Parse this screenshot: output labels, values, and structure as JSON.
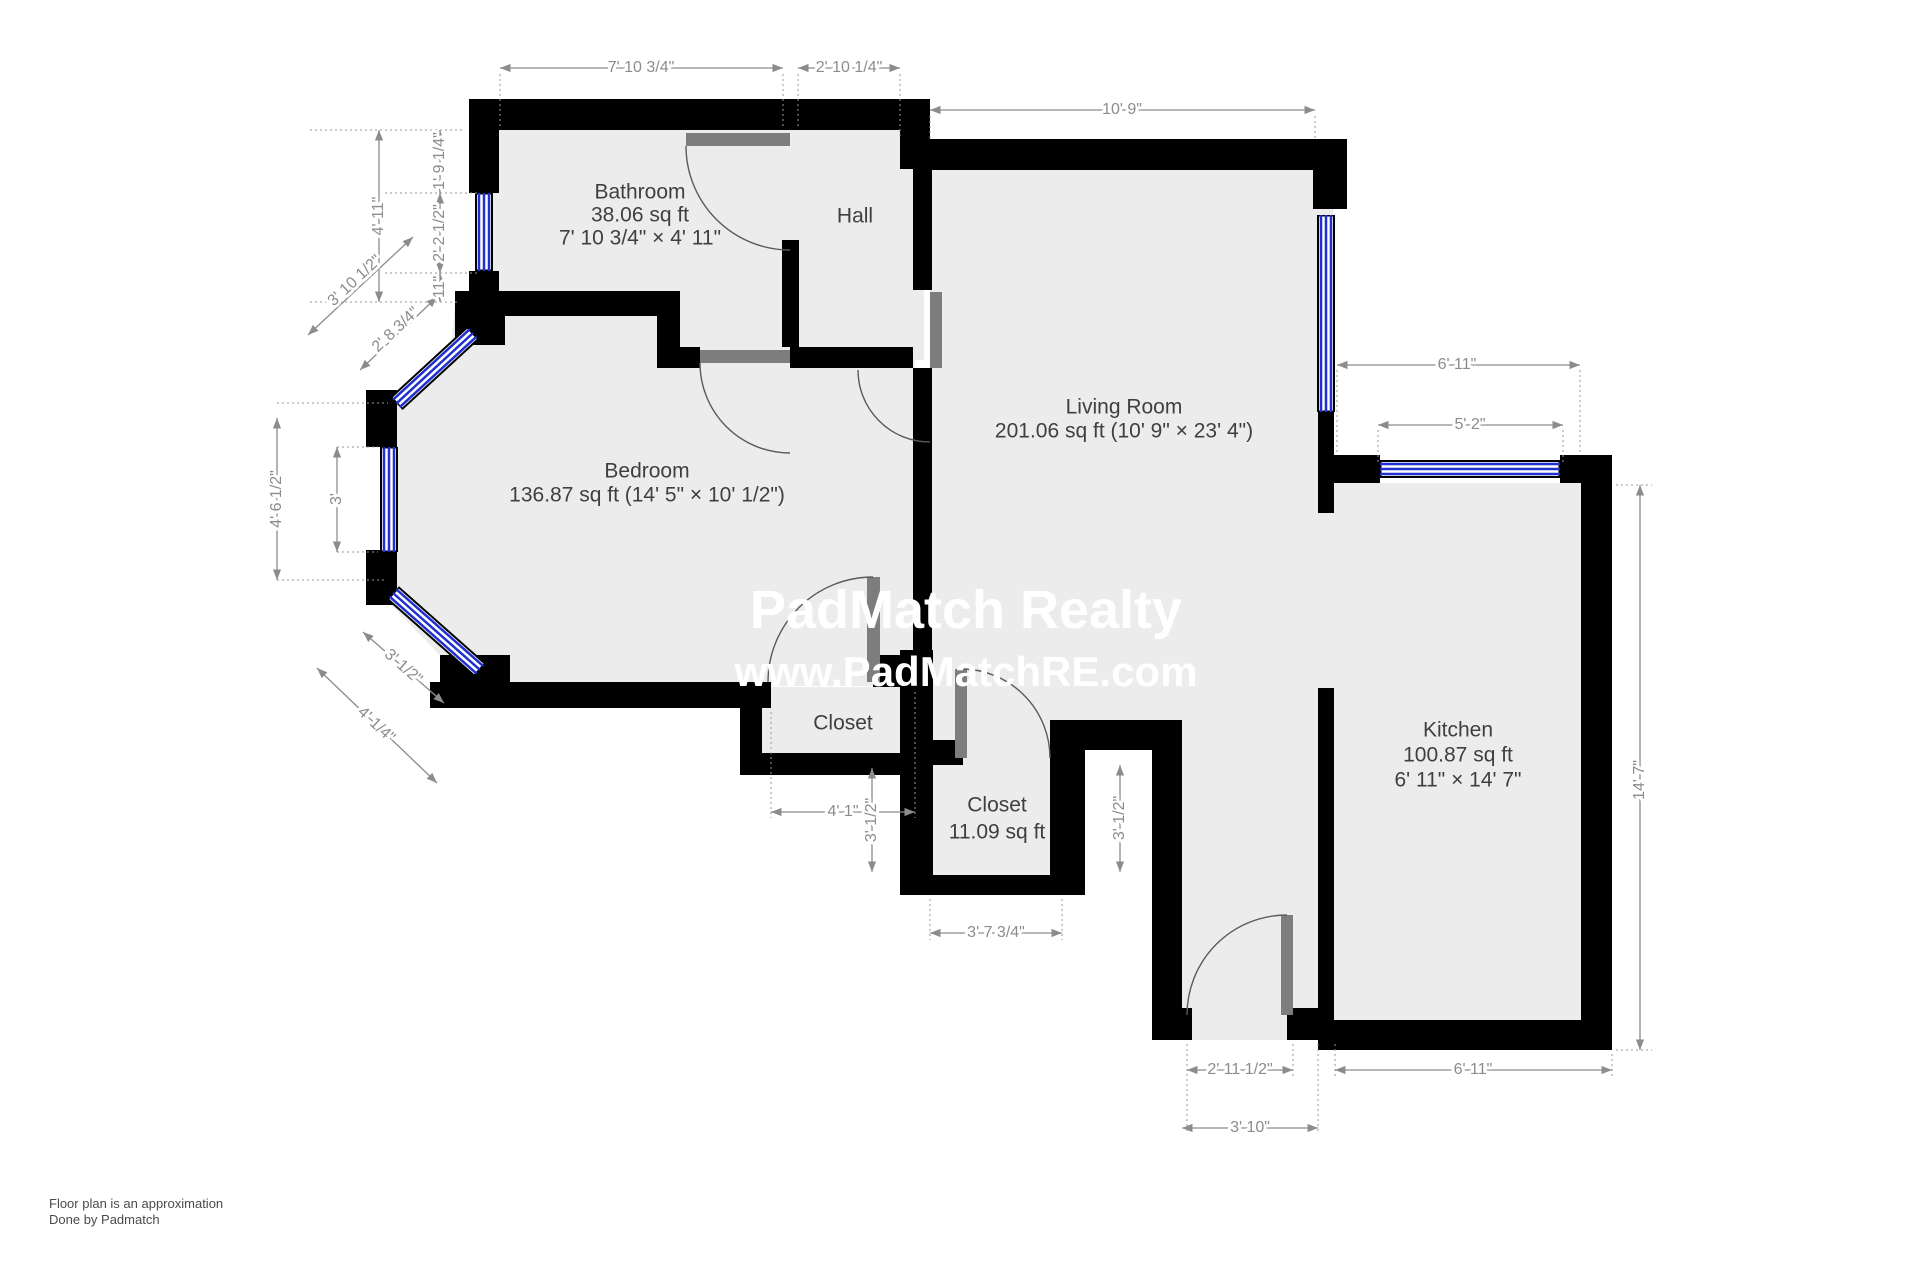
{
  "rooms": {
    "bathroom": {
      "name": "Bathroom",
      "area": "38.06 sq ft",
      "size": "7' 10 3/4\" × 4' 11\""
    },
    "hall": {
      "name": "Hall"
    },
    "living_room": {
      "name": "Living Room",
      "details": "201.06 sq ft (10' 9\" × 23' 4\")"
    },
    "bedroom": {
      "name": "Bedroom",
      "details": "136.87 sq ft (14' 5\" × 10' 1/2\")"
    },
    "closet_1": {
      "name": "Closet"
    },
    "closet_2": {
      "name": "Closet",
      "area": "11.09 sq ft"
    },
    "kitchen": {
      "name": "Kitchen",
      "area": "100.87 sq ft",
      "size": "6' 11\" × 14' 7\""
    }
  },
  "dims": [
    {
      "label": "7' 10 3/4\"",
      "edge": "top"
    },
    {
      "label": "2' 10 1/4\"",
      "edge": "top"
    },
    {
      "label": "10' 9\"",
      "edge": "top"
    },
    {
      "label": "4' 11\"",
      "edge": "left"
    },
    {
      "label": "1' 9 1/4\"",
      "edge": "left"
    },
    {
      "label": "2' 2 1/2\"",
      "edge": "left"
    },
    {
      "label": "11\"",
      "edge": "left"
    },
    {
      "label": "3' 10 1/2\"",
      "edge": "left-diagonal"
    },
    {
      "label": "2' 8 3/4\"",
      "edge": "left-diagonal"
    },
    {
      "label": "4' 6 1/2\"",
      "edge": "left"
    },
    {
      "label": "3'",
      "edge": "left"
    },
    {
      "label": "3' 1/2\"",
      "edge": "left-diagonal"
    },
    {
      "label": "4' 1/4\"",
      "edge": "left-diagonal"
    },
    {
      "label": "6' 11\"",
      "edge": "right-top"
    },
    {
      "label": "5' 2\"",
      "edge": "right-top"
    },
    {
      "label": "14' 7\"",
      "edge": "right"
    },
    {
      "label": "4' 1\"",
      "edge": "bottom"
    },
    {
      "label": "3' 1/2\"",
      "edge": "bottom"
    },
    {
      "label": "3' 7 3/4\"",
      "edge": "bottom"
    },
    {
      "label": "3' 1/2\"",
      "edge": "bottom"
    },
    {
      "label": "2' 11 1/2\"",
      "edge": "bottom"
    },
    {
      "label": "3' 10\"",
      "edge": "bottom"
    },
    {
      "label": "6' 11\"",
      "edge": "bottom"
    }
  ],
  "watermark": {
    "line1": "PadMatch Realty",
    "line2": "www.PadMatchRE.com"
  },
  "footer": {
    "line1": "Floor plan is an approximation",
    "line2": "Done by Padmatch"
  },
  "colors": {
    "wall": "#000000",
    "floor": "#ececec",
    "window_blue": "#1f2fd0",
    "dimension_gray": "#8c8c8c",
    "room_label": "#3f3f3f",
    "door_leaf": "#7d7d7d"
  }
}
